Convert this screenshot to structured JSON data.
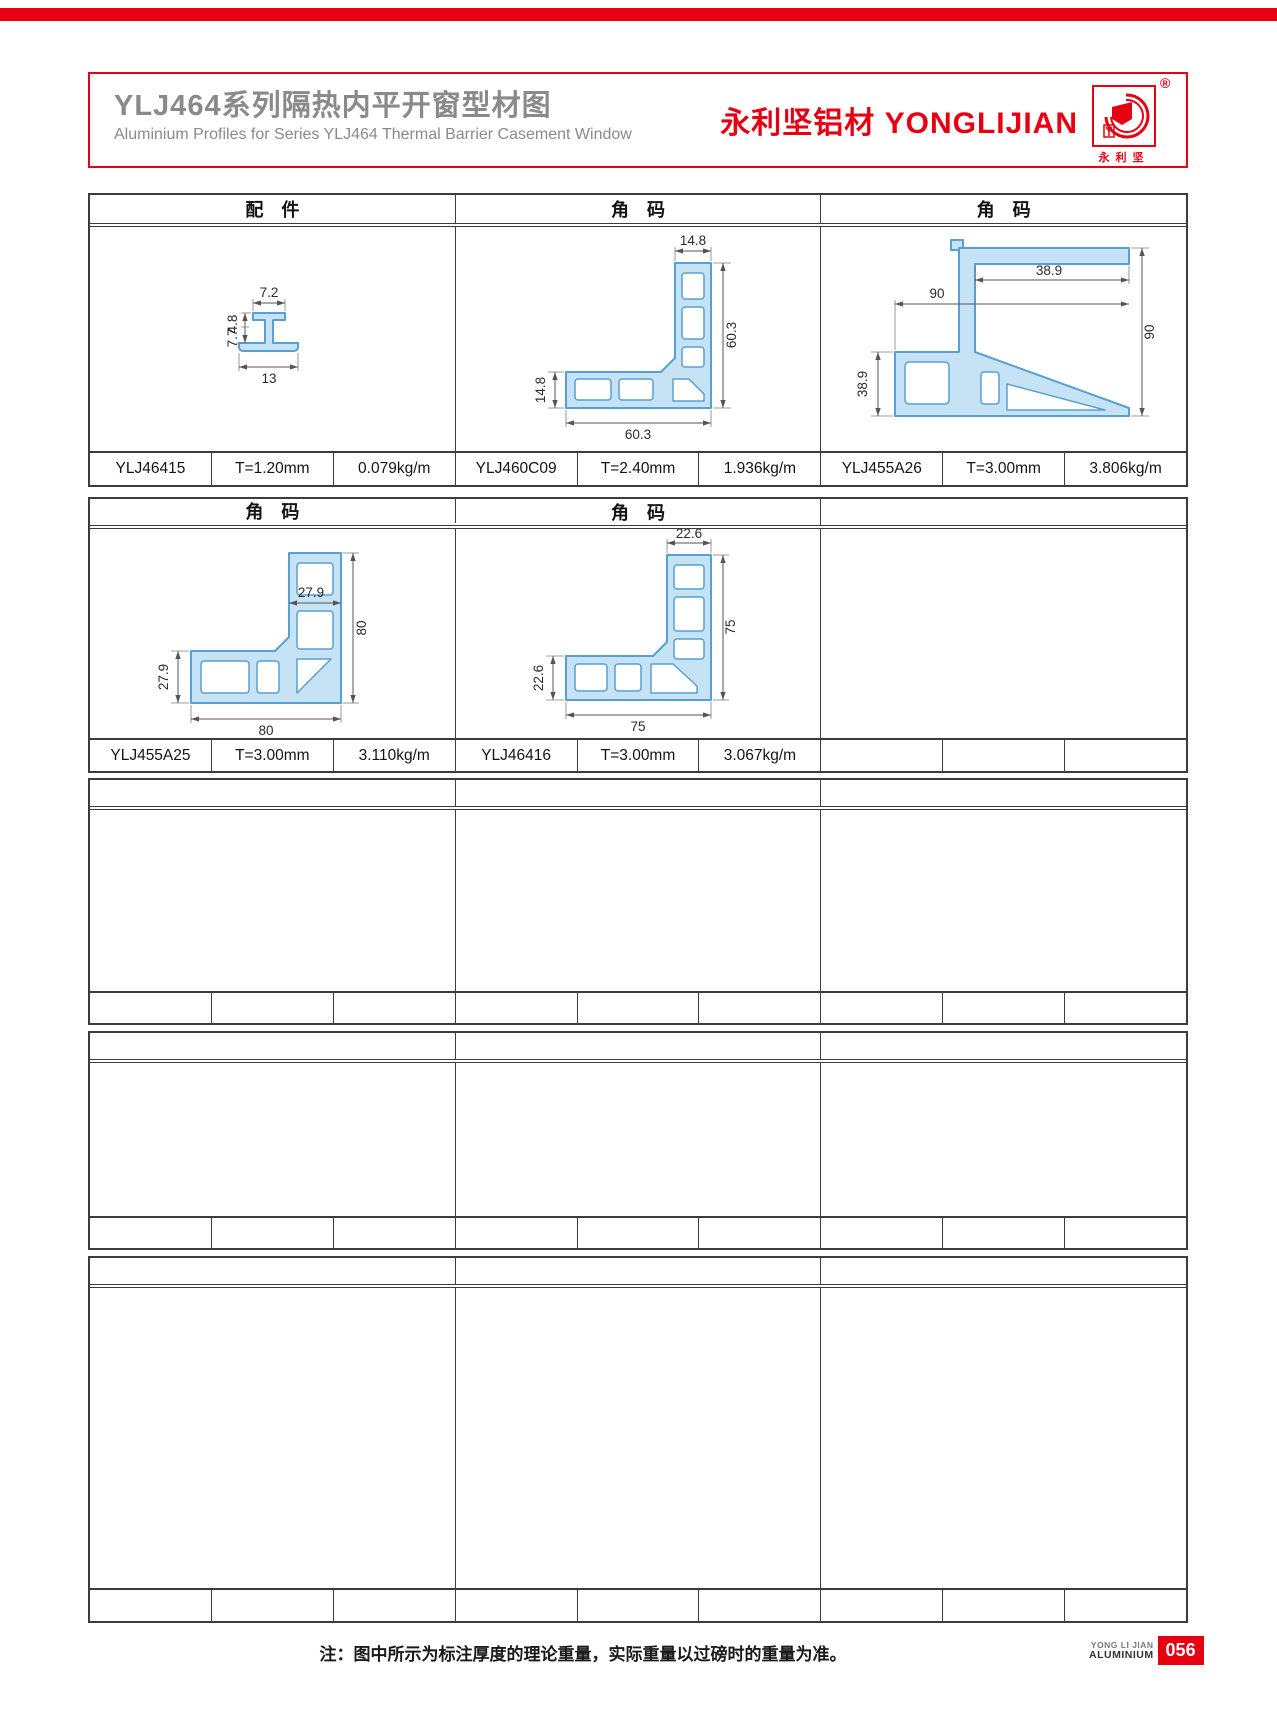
{
  "header": {
    "title_cn": "YLJ464系列隔热内平开窗型材图",
    "title_en": "Aluminium Profiles for Series YLJ464 Thermal Barrier Casement Window",
    "brand_cn": "永利坚铝材",
    "brand_en": "YONGLIJIAN",
    "logo_registered": "®",
    "logo_chars": "永利坚"
  },
  "colors": {
    "brand_red": "#e60012",
    "title_gray": "#8a8a8a",
    "profile_fill": "#c5e3f5",
    "profile_stroke": "#58a0d2",
    "table_line": "#3c3c3c"
  },
  "sections": [
    {
      "headers": [
        "配　件",
        "角　码",
        "角　码"
      ],
      "cells": [
        {
          "code": "YLJ46415",
          "thickness": "T=1.20mm",
          "weight": "0.079kg/m",
          "dims": {
            "top_w": "7.2",
            "upper_h": "4.8",
            "lower_h": "7.7",
            "bottom_w": "13"
          }
        },
        {
          "code": "YLJ460C09",
          "thickness": "T=2.40mm",
          "weight": "1.936kg/m",
          "dims": {
            "top": "14.8",
            "right": "60.3",
            "left": "14.8",
            "bottom": "60.3"
          }
        },
        {
          "code": "YLJ455A26",
          "thickness": "T=3.00mm",
          "weight": "3.806kg/m",
          "dims": {
            "flange": "38.9",
            "top": "90",
            "right": "90",
            "left": "38.9"
          }
        }
      ]
    },
    {
      "headers": [
        "角　码",
        "角　码",
        ""
      ],
      "cells": [
        {
          "code": "YLJ455A25",
          "thickness": "T=3.00mm",
          "weight": "3.110kg/m",
          "dims": {
            "top": "27.9",
            "right": "80",
            "left": "27.9",
            "bottom": "80"
          }
        },
        {
          "code": "YLJ46416",
          "thickness": "T=3.00mm",
          "weight": "3.067kg/m",
          "dims": {
            "top": "22.6",
            "right": "75",
            "left": "22.6",
            "bottom": "75"
          }
        },
        {
          "code": "",
          "thickness": "",
          "weight": ""
        }
      ]
    },
    {
      "headers": [
        "",
        "",
        ""
      ],
      "cells": [
        {
          "code": "",
          "thickness": "",
          "weight": ""
        },
        {
          "code": "",
          "thickness": "",
          "weight": ""
        },
        {
          "code": "",
          "thickness": "",
          "weight": ""
        }
      ]
    },
    {
      "headers": [
        "",
        "",
        ""
      ],
      "cells": [
        {
          "code": "",
          "thickness": "",
          "weight": ""
        },
        {
          "code": "",
          "thickness": "",
          "weight": ""
        },
        {
          "code": "",
          "thickness": "",
          "weight": ""
        }
      ]
    },
    {
      "headers": [
        "",
        "",
        ""
      ],
      "cells": [
        {
          "code": "",
          "thickness": "",
          "weight": ""
        },
        {
          "code": "",
          "thickness": "",
          "weight": ""
        },
        {
          "code": "",
          "thickness": "",
          "weight": ""
        }
      ]
    }
  ],
  "footer": {
    "note": "注：图中所示为标注厚度的理论重量，实际重量以过磅时的重量为准。",
    "badge_line1": "YONG LI JIAN",
    "badge_line2": "ALUMINIUM",
    "page_number": "056"
  }
}
